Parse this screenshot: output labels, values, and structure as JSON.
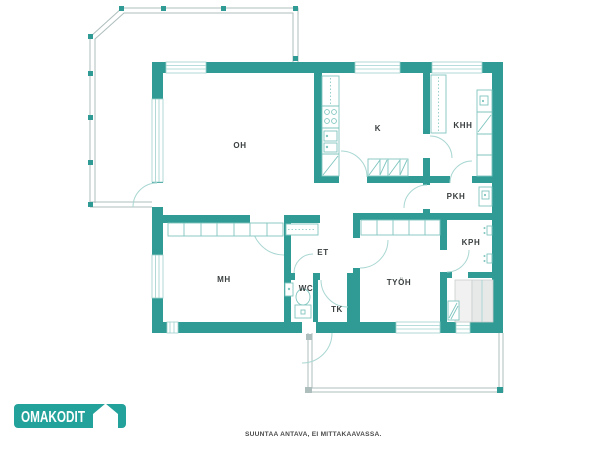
{
  "branding": {
    "logo_text": "OMAKODIT",
    "logo_icon": "house-icon",
    "disclaimer": "SUUNTAA ANTAVA, EI MITTAKAAVASSA."
  },
  "colors": {
    "wall": "#2f9b94",
    "logo": "#22a29a",
    "winframe": "#9ed2cd",
    "door": "#a9d7d2",
    "fixture": "#7fc5bf",
    "rail": "#aebebd"
  },
  "floorplan": {
    "rooms": [
      {
        "label": "OH"
      },
      {
        "label": "K"
      },
      {
        "label": "KHH"
      },
      {
        "label": "PKH"
      },
      {
        "label": "KPH"
      },
      {
        "label": "ET"
      },
      {
        "label": "MH"
      },
      {
        "label": "WC"
      },
      {
        "label": "TK"
      },
      {
        "label": "TYÖH"
      }
    ]
  }
}
